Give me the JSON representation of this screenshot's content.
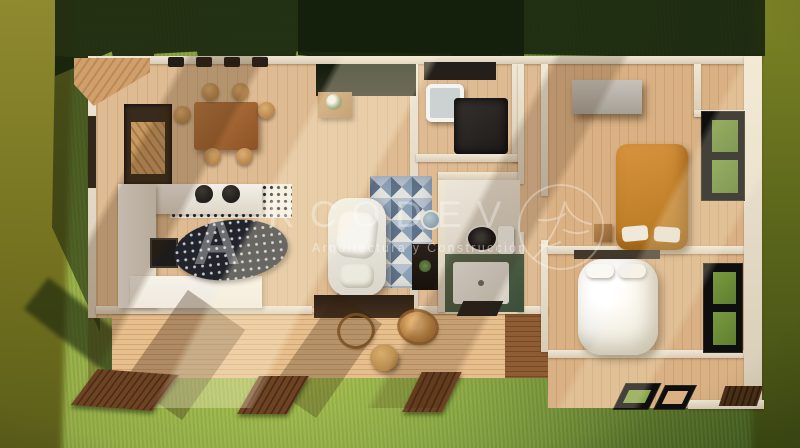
{
  "watermark": {
    "brand_initial": "A",
    "brand_rest": "RCODEV",
    "brand_full": "ARCODEV",
    "tagline": "Arquitectura y Construcción",
    "logo_icon": "circle-tree-branch-logo",
    "text_color": "#FFFFFF"
  },
  "scene": {
    "type": "top-down 3D render of a single-storey house floor plan on a lawn",
    "elements": [
      "lawn",
      "roof-shadow",
      "entry-ramp",
      "entry-porch",
      "dining-table",
      "dining-chairs",
      "kitchen-counter",
      "cooktop",
      "kitchen-sink",
      "bar-stools",
      "patterned-tiles",
      "patterned-rug",
      "plant-console",
      "accent-triangle-wall",
      "lounge-armchair",
      "hall-mirror",
      "media-console",
      "laundry-counter",
      "laundry-sink",
      "washer",
      "toilet",
      "cistern",
      "shower-tray",
      "bath-mat",
      "wardrobe",
      "orange-bed",
      "nightstand",
      "white-bed",
      "headboard",
      "window-top-right",
      "window-bottom-right",
      "wood-deck",
      "rattan-chair",
      "coffee-table",
      "garden-walkways",
      "patio-door-frames",
      "patio-slats"
    ],
    "palette": {
      "grass_light": "#97AE42",
      "grass_dark": "#455F1F",
      "olive_blur": "#7D7F24",
      "shadow_green": "#18250E",
      "wall_cream": "#E8DECB",
      "wood_floor": "#D8B48C",
      "deck_wood": "#DCAE7B",
      "walkway_wood": "#5A3A1F",
      "bed_orange": "#C98231",
      "duvet_white": "#F3F1EC",
      "accent_triangle_blue": "#7E92A9",
      "shower_green": "#4B5D46",
      "window_frame": "#0E0E0E"
    }
  }
}
